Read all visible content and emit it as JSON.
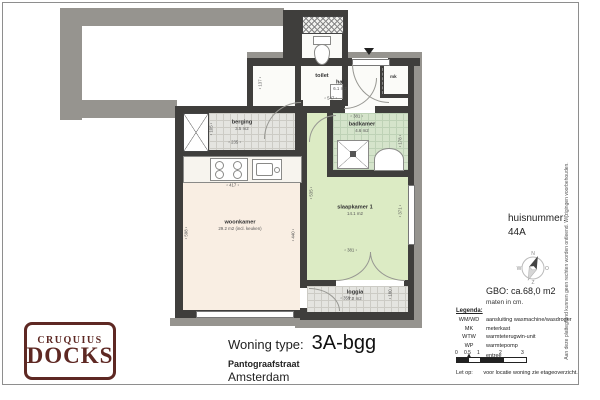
{
  "plan": {
    "rooms": {
      "toilet": {
        "name": "toilet"
      },
      "hal": {
        "name": "hal",
        "area": "6.1 m2"
      },
      "mk": {
        "name": "mk"
      },
      "berging": {
        "name": "berging",
        "area": "3.5 m2"
      },
      "badkamer": {
        "name": "badkamer",
        "area": "4.6 m2"
      },
      "woonkamer": {
        "name": "woonkamer",
        "area": "29.2 m2 (incl. keuken)"
      },
      "slaapkamer1": {
        "name": "slaapkamer 1",
        "area": "14.1 m2"
      },
      "loggia": {
        "name": "loggia",
        "area": "7.2 m2"
      }
    },
    "dims": [
      "137",
      "547",
      "381",
      "105",
      "235",
      "178",
      "417",
      "598",
      "440",
      "535",
      "371",
      "381",
      "359",
      "180"
    ]
  },
  "panel": {
    "huisnummer_label": "huisnummer:",
    "huisnummer_value": "44A",
    "compass": {
      "n": "N",
      "e": "O",
      "s": "Z",
      "w": "W"
    },
    "gbo": "GBO: ca.68,0 m2",
    "maten": "maten in cm.",
    "legend_title": "Legenda:",
    "legend": [
      {
        "key": "WM/WD",
        "value": "aansluiting wasmachine/wasdroger"
      },
      {
        "key": "MK",
        "value": "meterkast"
      },
      {
        "key": "WTW",
        "value": "warmteterugwin-unit"
      },
      {
        "key": "WP",
        "value": "warmtepomp"
      },
      {
        "key": "▲",
        "value": "entree"
      }
    ],
    "scale_ticks": [
      "0",
      "0.5",
      "1",
      "2",
      "3"
    ],
    "note_label": "Let op:",
    "note_text": "voor locatie woning zie etageoverzicht."
  },
  "titleblock": {
    "label": "Woning type:",
    "type": "3A-bgg",
    "street": "Pantograafstraat",
    "city": "Amsterdam"
  },
  "logo": {
    "line1": "CRUQUIUS",
    "line2": "DOCKS"
  },
  "disclaimer": "Aan deze plattegrond kunnen geen rechten worden ontleend. Wijzigingen voorbehouden.",
  "colors": {
    "logo_maroon": "#5e2823",
    "wall_dark": "#3f3e3c",
    "cladding_gray": "#96948f",
    "woonkamer_fill": "#f9eee3",
    "slaapkamer_fill": "#dcebc4",
    "badkamer_fill": "#d5e4cb",
    "tile_gray": "#e4e4e0"
  }
}
